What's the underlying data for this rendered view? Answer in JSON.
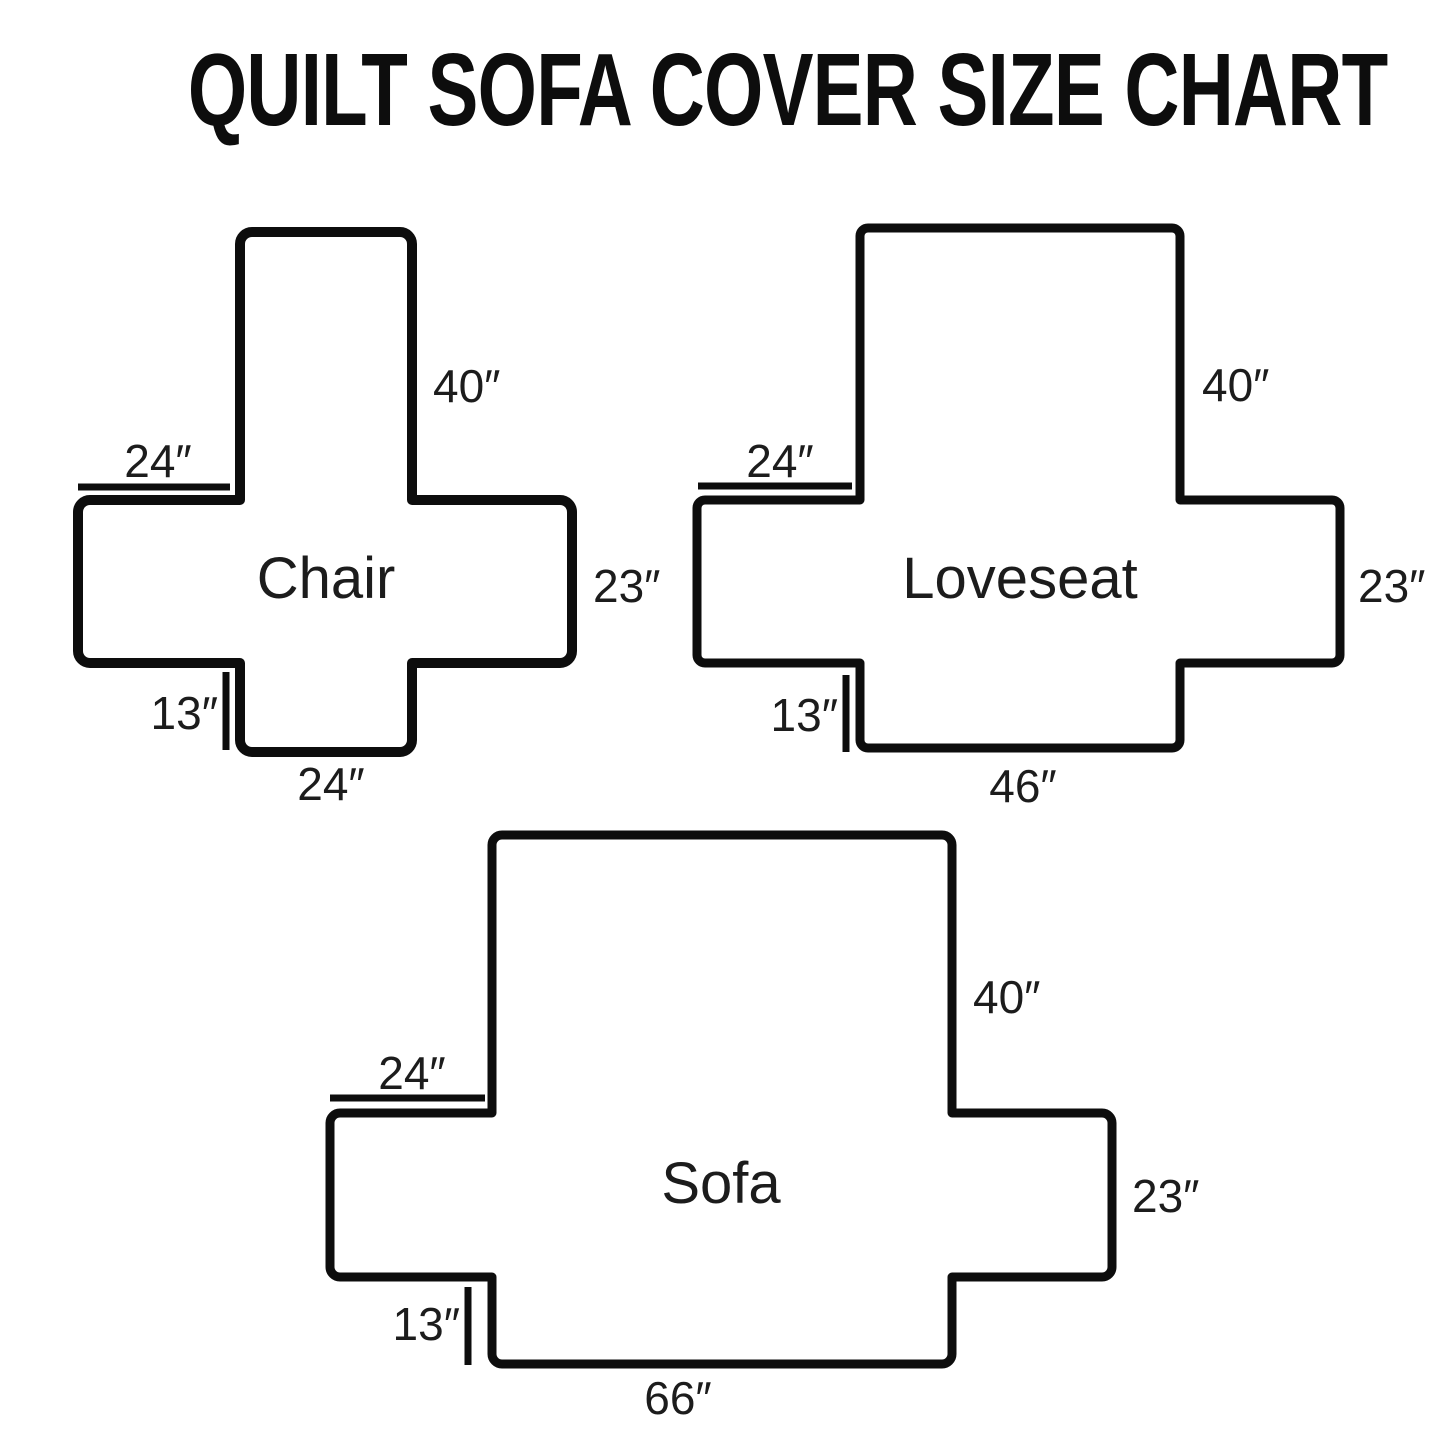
{
  "title": "QUILT SOFA COVER SIZE CHART",
  "colors": {
    "ink": "#0d0d0d",
    "background": "#ffffff"
  },
  "diagrams": [
    {
      "name": "Chair",
      "back_height": "40″",
      "arm_top_width": "24″",
      "arm_side_height": "23″",
      "front_drop": "13″",
      "front_width": "24″"
    },
    {
      "name": "Loveseat",
      "back_height": "40″",
      "arm_top_width": "24″",
      "arm_side_height": "23″",
      "front_drop": "13″",
      "front_width": "46″"
    },
    {
      "name": "Sofa",
      "back_height": "40″",
      "arm_top_width": "24″",
      "arm_side_height": "23″",
      "front_drop": "13″",
      "front_width": "66″"
    }
  ]
}
